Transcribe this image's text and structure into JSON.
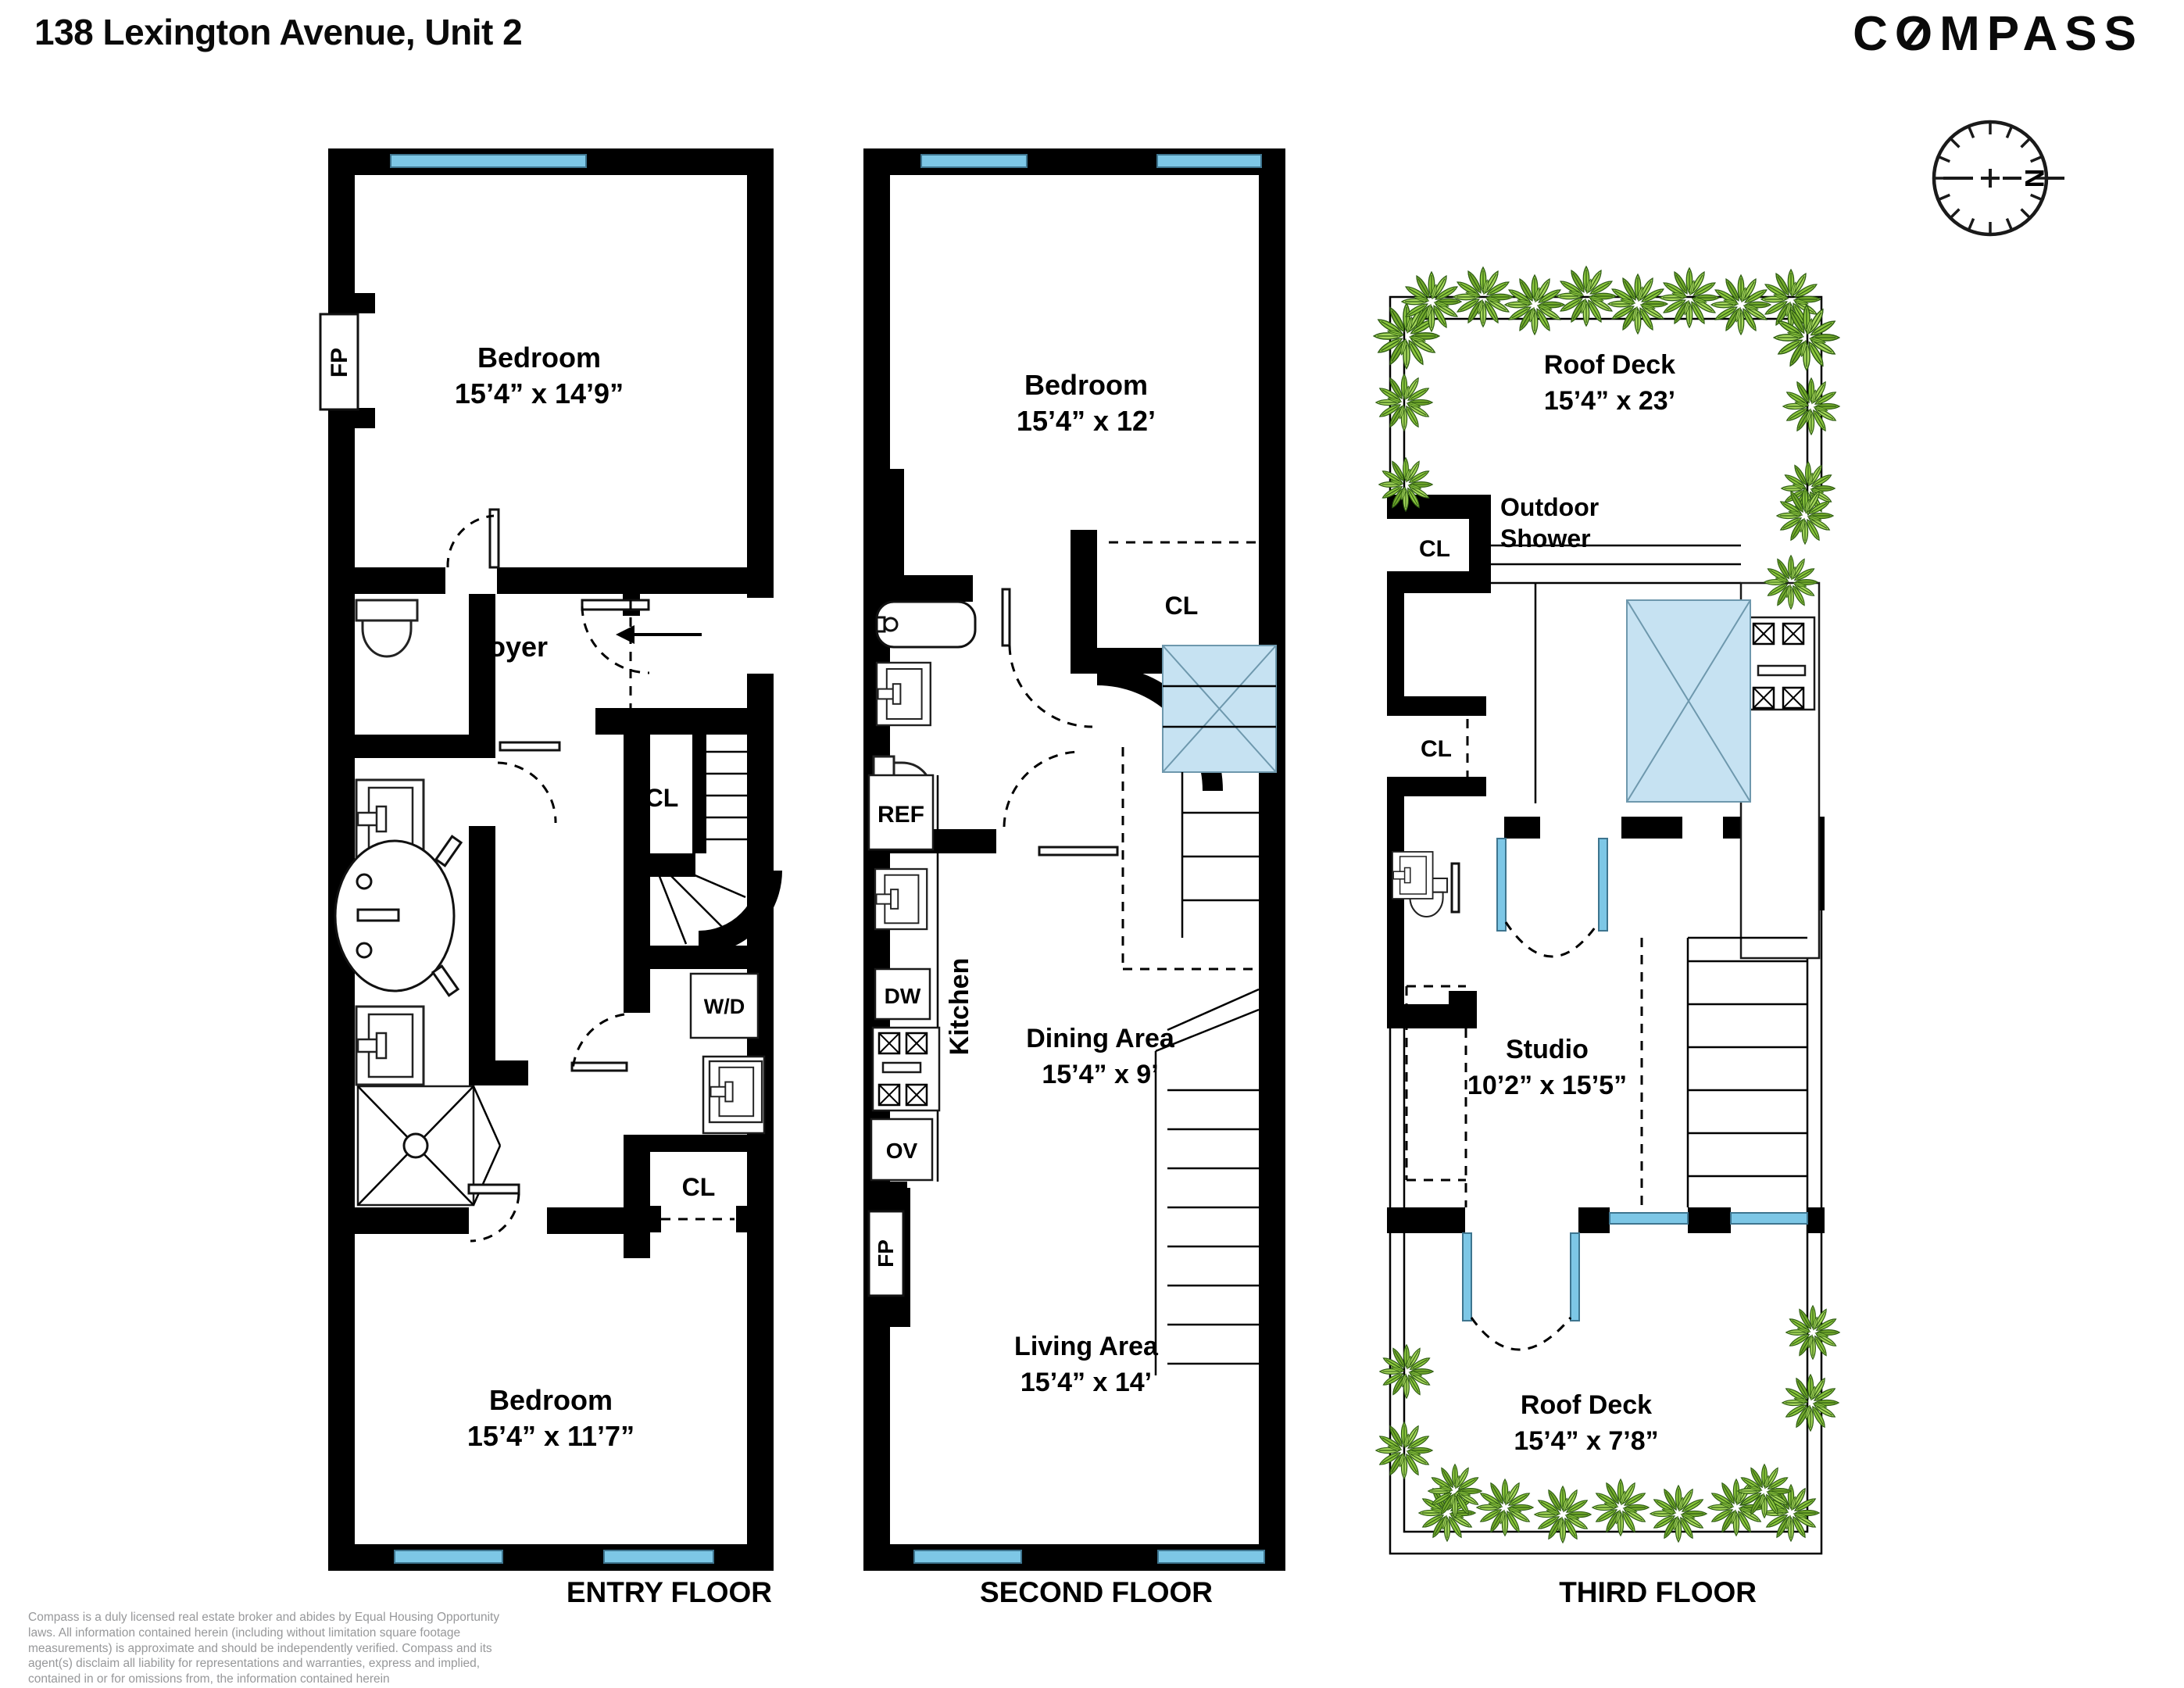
{
  "header": {
    "title": "138 Lexington Avenue, Unit 2",
    "brand_c": "C",
    "brand_o": "O",
    "brand_rest": "MPASS"
  },
  "compass_rose": {
    "north": "N"
  },
  "floors": {
    "entry": {
      "label": "ENTRY FLOOR",
      "fp": "FP",
      "bedroom1": {
        "name": "Bedroom",
        "dims": "15’4” x 14’9”"
      },
      "foyer": "Foyer",
      "cl_stairs": "CL",
      "wd": "W/D",
      "cl_closet": "CL",
      "bedroom2": {
        "name": "Bedroom",
        "dims": "15’4” x 11’7”"
      }
    },
    "second": {
      "label": "SECOND FLOOR",
      "bedroom": {
        "name": "Bedroom",
        "dims": "15’4” x 12’"
      },
      "cl": "CL",
      "ref": "REF",
      "dw": "DW",
      "ov": "OV",
      "fp": "FP",
      "kitchen": "Kitchen",
      "dining": {
        "name": "Dining Area",
        "dims": "15’4” x 9’"
      },
      "living": {
        "name": "Living Area",
        "dims": "15’4” x 14’"
      }
    },
    "third": {
      "label": "THIRD FLOOR",
      "roof_deck_top": {
        "name": "Roof Deck",
        "dims": "15’4” x 23’"
      },
      "outdoor_shower": {
        "line1": "Outdoor",
        "line2": "Shower"
      },
      "cl_upper": "CL",
      "cl_lower": "CL",
      "studio": {
        "name": "Studio",
        "dims": "10’2” x 15’5”"
      },
      "roof_deck_bottom": {
        "name": "Roof Deck",
        "dims": "15’4” x 7’8”"
      }
    }
  },
  "disclaimer": "Compass is a duly licensed real estate broker and abides by Equal Housing Opportunity laws. All information contained herein (including without limitation square footage measurements) is approximate and should be independently verified. Compass and its agent(s) disclaim all liability for representations and warranties, express and implied, contained in or for omissions from, the information contained herein"
}
